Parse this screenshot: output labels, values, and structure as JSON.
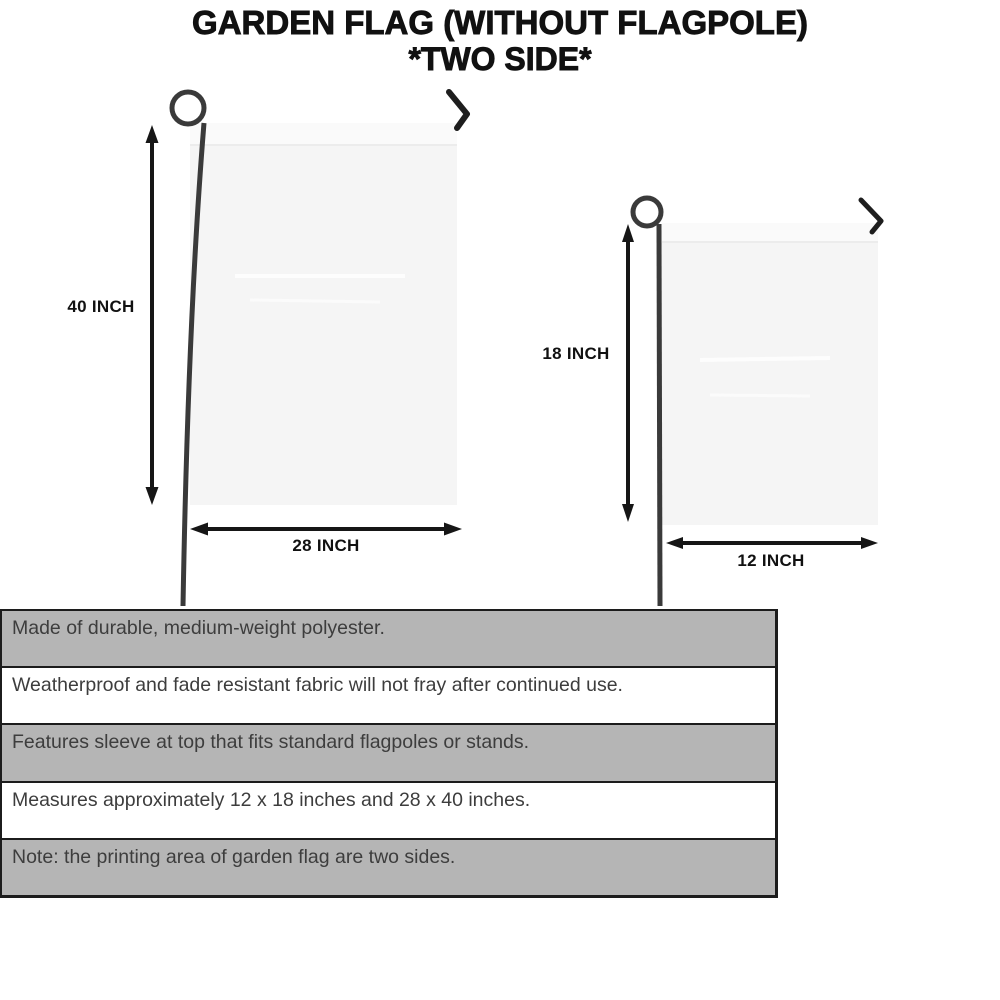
{
  "title": {
    "line1": "GARDEN FLAG (WITHOUT FLAGPOLE)",
    "line2": "*TWO SIDE*"
  },
  "diagram": {
    "large_flag": {
      "height_label": "40 INCH",
      "width_label": "28 INCH"
    },
    "small_flag": {
      "height_label": "18 INCH",
      "width_label": "12 INCH"
    }
  },
  "features": [
    "Made of durable, medium-weight polyester.",
    "Weatherproof and fade resistant fabric will not fray after continued use.",
    "Features sleeve at top that fits standard flagpoles or stands.",
    "Measures approximately 12 x 18 inches and 28 x 40 inches.",
    "Note: the printing area of garden flag are two sides."
  ],
  "colors": {
    "title_text": "#111111",
    "diagram_line": "#2b2b2b",
    "flag_fill": "#f5f5f5",
    "flag_sleeve": "#fafafa",
    "feature_row_gray": "#b5b5b5",
    "feature_row_white": "#ffffff",
    "feature_border": "#1c1c1c",
    "feature_text": "#3d3d3d"
  }
}
